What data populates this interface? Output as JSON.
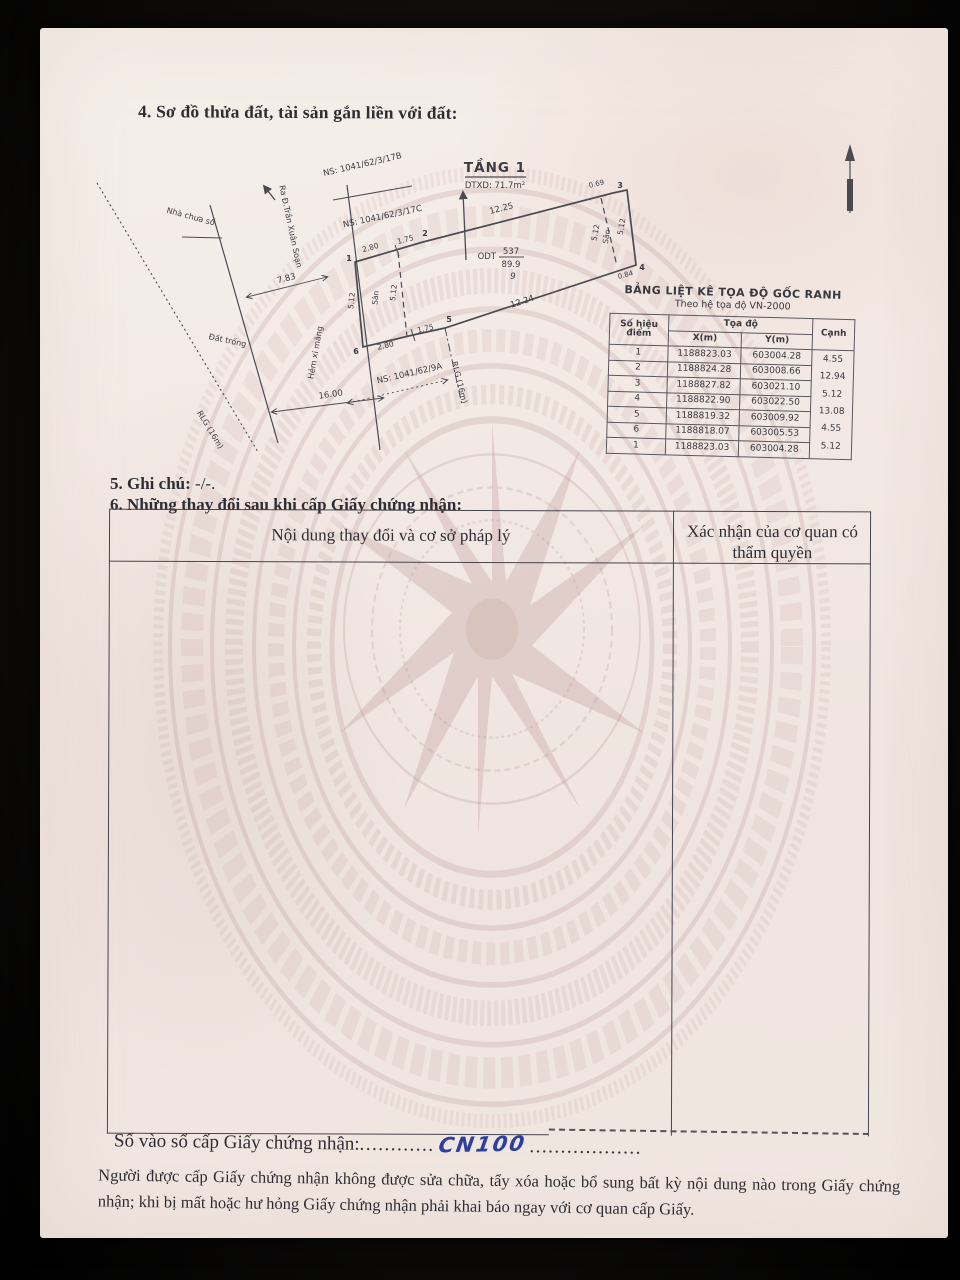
{
  "doc": {
    "section4_title": "4. Sơ đồ thửa đất, tài sản gắn liền với đất:",
    "section5_label": "5. Ghi chú:",
    "section5_value": " -/-.",
    "section6_title": "6. Những thay đổi sau khi cấp Giấy chứng nhận:",
    "changes_table": {
      "col1_header": "Nội dung thay đổi và cơ sở pháp lý",
      "col2_header": "Xác nhận của cơ quan có thẩm quyền"
    },
    "book_label": "Số vào sổ cấp Giấy chứng nhận:",
    "book_dots1": "............",
    "book_value": "CN100",
    "book_dots2": "..................",
    "footer_note": "Người được cấp Giấy chứng nhận không được sửa chữa, tẩy xóa hoặc bổ sung bất kỳ nội dung nào trong Giấy chứng nhận; khi bị mất hoặc hư hỏng Giấy chứng nhận phải khai báo ngay với cơ quan cấp Giấy."
  },
  "diagram": {
    "floor_title": "TẦNG 1",
    "floor_area": "DTXD: 71.7m²",
    "lot": {
      "code": "ODT",
      "number": "537",
      "area": "89.9",
      "sheet": "9"
    },
    "labels": {
      "ns17b": "NS: 1041/62/3/17B",
      "ns17c": "NS: 1041/62/3/17C",
      "ns9a": "NS: 1041/62/9A",
      "nha_chua_so": "Nhà chưa số",
      "ra_duong": "Ra Đ.Trần Xuân Soạn",
      "dat_trong": "Đất trống",
      "hem": "Hẻm xi măng",
      "rlg_left": "RLG (16m)",
      "rlg_right": "RLG (16m)",
      "san_left": "Sân",
      "san_right": "Sân"
    },
    "dims": {
      "d783": "7.83",
      "d1600": "16.00",
      "d1225": "12.25",
      "d1224": "12.24",
      "d280t": "2.80",
      "d175t": "1.75",
      "d280b": "2.80",
      "d175b": "1.75",
      "s512_le": "5.12",
      "s512_ld": "5.12",
      "s512_re": "5.12",
      "s512_rd": "5.12",
      "d069": "0.69",
      "d084": "0.84"
    },
    "points": {
      "p1": "1",
      "p2": "2",
      "p3": "3",
      "p4": "4",
      "p5": "5",
      "p6": "6"
    }
  },
  "coord_table": {
    "title": "BẢNG LIỆT KÊ TỌA ĐỘ GỐC RANH",
    "subtitle": "Theo hệ tọa độ VN-2000",
    "headers": {
      "point": "Số hiệu điểm",
      "coords": "Tọa độ",
      "x": "X(m)",
      "y": "Y(m)",
      "edge": "Cạnh"
    },
    "rows": [
      {
        "n": "1",
        "x": "1188823.03",
        "y": "603004.28"
      },
      {
        "n": "2",
        "x": "1188824.28",
        "y": "603008.66"
      },
      {
        "n": "3",
        "x": "1188827.82",
        "y": "603021.10"
      },
      {
        "n": "4",
        "x": "1188822.90",
        "y": "603022.50"
      },
      {
        "n": "5",
        "x": "1188819.32",
        "y": "603009.92"
      },
      {
        "n": "6",
        "x": "1188818.07",
        "y": "603005.53"
      },
      {
        "n": "1",
        "x": "1188823.03",
        "y": "603004.28"
      }
    ],
    "edges": [
      "4.55",
      "12.94",
      "5.12",
      "13.08",
      "4.55",
      "5.12"
    ]
  }
}
